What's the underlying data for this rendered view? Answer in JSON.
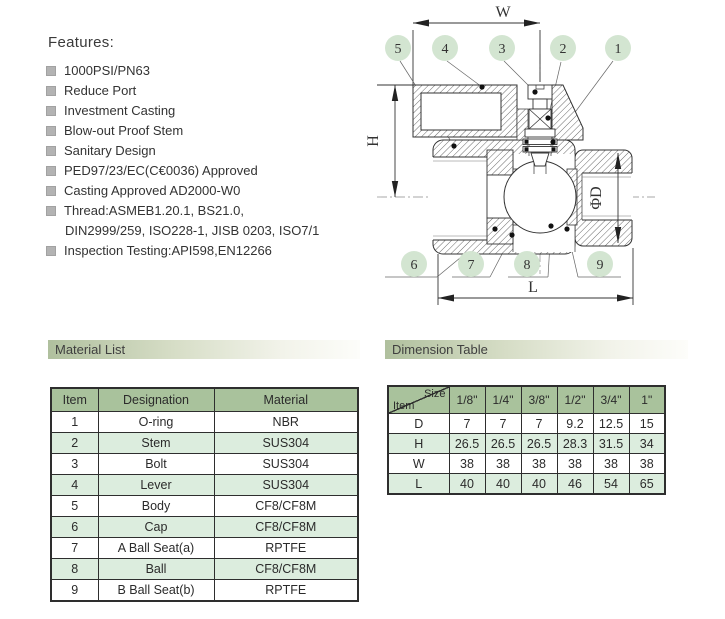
{
  "features": {
    "title": "Features:",
    "items": [
      "1000PSI/PN63",
      "Reduce Port",
      "Investment Casting",
      "Blow-out Proof Stem",
      "Sanitary Design",
      "PED97/23/EC(C€0036) Approved",
      "Casting Approved AD2000-W0",
      "Thread:ASMEB1.20.1, BS21.0,",
      "Inspection Testing:API598,EN12266"
    ],
    "thread_continuation": "DIN2999/259,  ISO228-1, JISB 0203, ISO7/1"
  },
  "drawing": {
    "dim_labels": {
      "w": "W",
      "h": "H",
      "l": "L",
      "d": "ΦD"
    },
    "callouts": {
      "c1": "1",
      "c2": "2",
      "c3": "3",
      "c4": "4",
      "c5": "5",
      "c6": "6",
      "c7": "7",
      "c8": "8",
      "c9": "9"
    }
  },
  "material_section": {
    "title": "Material List"
  },
  "material_table": {
    "headers": [
      "Item",
      "Designation",
      "Material"
    ],
    "rows": [
      [
        "1",
        "O-ring",
        "NBR"
      ],
      [
        "2",
        "Stem",
        "SUS304"
      ],
      [
        "3",
        "Bolt",
        "SUS304"
      ],
      [
        "4",
        "Lever",
        "SUS304"
      ],
      [
        "5",
        "Body",
        "CF8/CF8M"
      ],
      [
        "6",
        "Cap",
        "CF8/CF8M"
      ],
      [
        "7",
        "A Ball Seat(a)",
        "RPTFE"
      ],
      [
        "8",
        "Ball",
        "CF8/CF8M"
      ],
      [
        "9",
        "B Ball Seat(b)",
        "RPTFE"
      ]
    ]
  },
  "dimension_section": {
    "title": "Dimension Table"
  },
  "dimension_table": {
    "corner": {
      "size_label": "Size",
      "item_label": "Item"
    },
    "sizes": [
      "1/8\"",
      "1/4\"",
      "3/8\"",
      "1/2\"",
      "3/4\"",
      "1\""
    ],
    "rows": [
      {
        "label": "D",
        "values": [
          "7",
          "7",
          "7",
          "9.2",
          "12.5",
          "15"
        ]
      },
      {
        "label": "H",
        "values": [
          "26.5",
          "26.5",
          "26.5",
          "28.3",
          "31.5",
          "34"
        ]
      },
      {
        "label": "W",
        "values": [
          "38",
          "38",
          "38",
          "38",
          "38",
          "38"
        ]
      },
      {
        "label": "L",
        "values": [
          "40",
          "40",
          "40",
          "46",
          "54",
          "65"
        ]
      }
    ]
  },
  "colors": {
    "table_header_green": "#a9c29c",
    "table_row_green": "#dcedde",
    "bar_green": "#b0c09e",
    "callout_green": "#d3e5d1"
  }
}
